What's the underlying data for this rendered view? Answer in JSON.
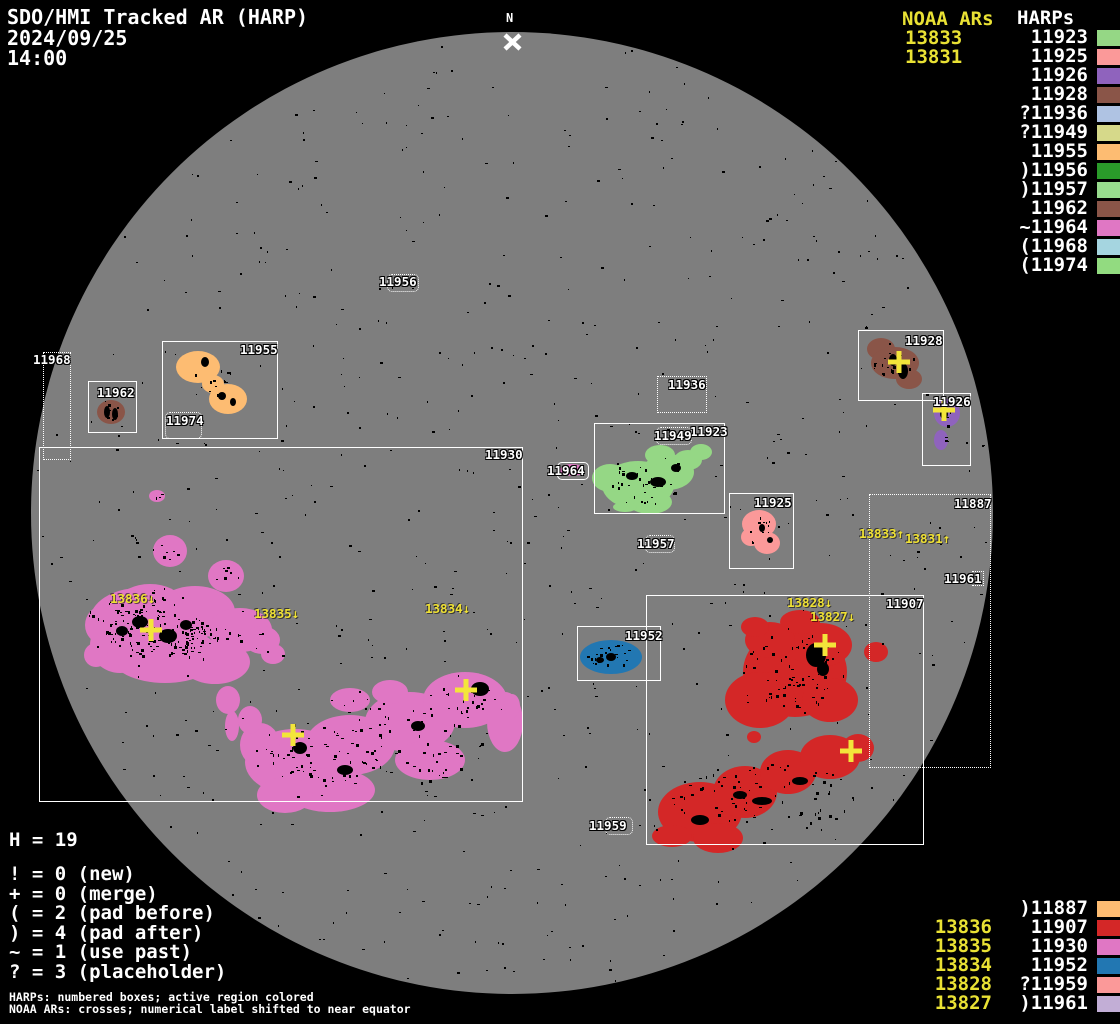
{
  "header": {
    "title": "SDO/HMI Tracked AR (HARP)",
    "date": "2024/09/25",
    "time": "14:00"
  },
  "north_marker": "N",
  "stats": {
    "harp_count": "H = 19"
  },
  "symbol_legend": [
    "! = 0 (new)",
    "+ = 0 (merge)",
    "( = 2 (pad before)",
    ") = 4 (pad after)",
    "~ = 1 (use past)",
    "? = 3 (placeholder)"
  ],
  "footnotes": [
    "HARPs: numbered boxes; active region colored",
    "NOAA ARs: crosses; numerical label shifted to near equator"
  ],
  "legend_top_right": {
    "noaa_title": "NOAA ARs",
    "noaa_items": [
      "13833",
      "13831"
    ],
    "harps_title": "HARPs",
    "harp_items": [
      {
        "label": "11923",
        "harp": "11923"
      },
      {
        "label": "11925",
        "harp": "11925"
      },
      {
        "label": "11926",
        "harp": "11926"
      },
      {
        "label": "11928",
        "harp": "11928"
      },
      {
        "label": "?11936",
        "harp": "11936"
      },
      {
        "label": "?11949",
        "harp": "11949"
      },
      {
        "label": "11955",
        "harp": "11955"
      },
      {
        "label": ")11956",
        "harp": "11956"
      },
      {
        "label": ")11957",
        "harp": "11957"
      },
      {
        "label": "11962",
        "harp": "11962"
      },
      {
        "label": "~11964",
        "harp": "11964"
      },
      {
        "label": "(11968",
        "harp": "11968"
      },
      {
        "label": "(11974",
        "harp": "11974"
      }
    ]
  },
  "legend_bottom_right": {
    "rows": [
      {
        "noaa": "",
        "harp_label": ")11887",
        "harp": "11887"
      },
      {
        "noaa": "13836",
        "harp_label": "11907",
        "harp": "11907"
      },
      {
        "noaa": "13835",
        "harp_label": "11930",
        "harp": "11930"
      },
      {
        "noaa": "13834",
        "harp_label": "11952",
        "harp": "11952"
      },
      {
        "noaa": "13828",
        "harp_label": "?11959",
        "harp": "11959"
      },
      {
        "noaa": "13827",
        "harp_label": ")11961",
        "harp": "11961"
      }
    ]
  },
  "disk": {
    "harp_boxes": [
      {
        "harp": "11930",
        "label": "11930",
        "style": "solid"
      },
      {
        "harp": "11907",
        "label": "11907",
        "style": "solid"
      },
      {
        "harp": "11955",
        "label": "11955",
        "style": "solid"
      },
      {
        "harp": "11962",
        "label": "11962",
        "style": "solid"
      },
      {
        "harp": "11928",
        "label": "11928",
        "style": "solid"
      },
      {
        "harp": "11926",
        "label": "11926",
        "style": "solid"
      },
      {
        "harp": "11923",
        "label": "11923",
        "style": "solid"
      },
      {
        "harp": "11925",
        "label": "11925",
        "style": "solid"
      },
      {
        "harp": "11952",
        "label": "11952",
        "style": "solid"
      },
      {
        "harp": "11964",
        "label": "11964",
        "style": "solid"
      },
      {
        "harp": "11887",
        "label": "11887",
        "style": "dotted"
      },
      {
        "harp": "11968",
        "label": "11968",
        "style": "dotted"
      },
      {
        "harp": "11974",
        "label": "11974",
        "style": "dotted"
      },
      {
        "harp": "11936",
        "label": "11936",
        "style": "dotted"
      },
      {
        "harp": "11949",
        "label": "11949",
        "style": "dotted"
      },
      {
        "harp": "11956",
        "label": "11956",
        "style": "dotted"
      },
      {
        "harp": "11957",
        "label": "11957",
        "style": "dotted"
      },
      {
        "harp": "11959",
        "label": "11959",
        "style": "dotted"
      },
      {
        "harp": "11961",
        "label": "11961",
        "style": "dotted"
      }
    ],
    "noaa_pointers": [
      {
        "text": "13836↓"
      },
      {
        "text": "13835↓"
      },
      {
        "text": "13834↓"
      },
      {
        "text": "13828↓"
      },
      {
        "text": "13827↓"
      },
      {
        "text": "13833↑"
      },
      {
        "text": "13831↑"
      }
    ]
  },
  "colors": {
    "background": "#000000",
    "disk": "#7e7e7e",
    "box_line": "#ffffff",
    "noaa_text": "#e9e134",
    "cross": "#f3e53a",
    "regions": {
      "11923": "#95d785",
      "11925": "#fb9999",
      "11926": "#8f63bd",
      "11928": "#8a5548",
      "11936": "#afc3e3",
      "11949": "#d6d98a",
      "11955": "#fdbc72",
      "11956": "#2a9b2a",
      "11957": "#98dc8e",
      "11962": "#8a5548",
      "11964": "#e077c4",
      "11968": "#a5d5e0",
      "11974": "#92db80",
      "11887": "#fdbc72",
      "11907": "#d42727",
      "11930": "#e077c4",
      "11952": "#2277b2",
      "11959": "#fb9999",
      "11961": "#c2aed6"
    }
  }
}
